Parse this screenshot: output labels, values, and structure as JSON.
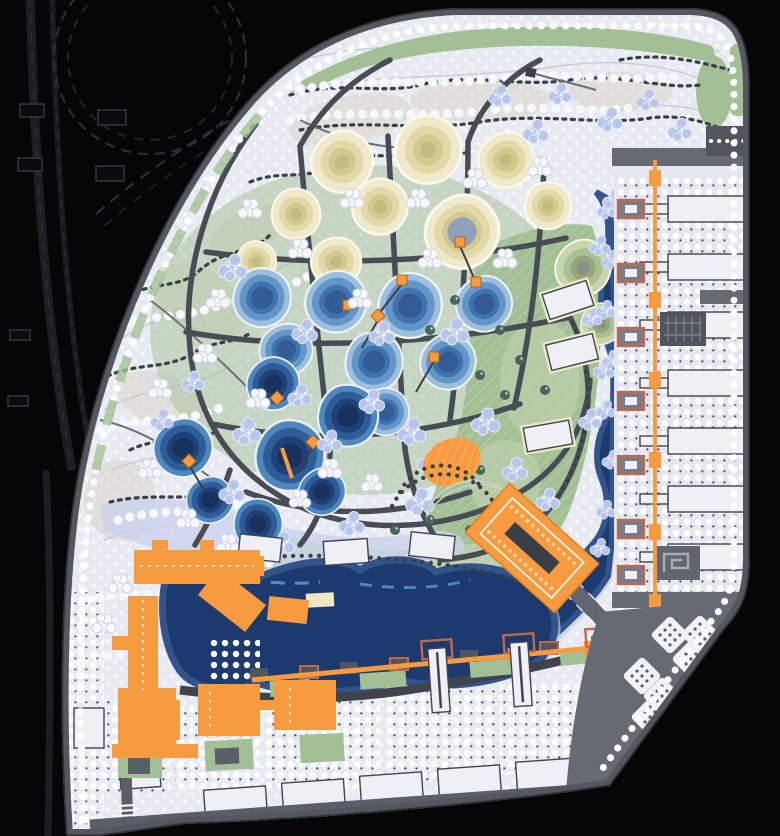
{
  "meta": {
    "type": "landscape-masterplan-site-plan",
    "canvas_px": {
      "width": 780,
      "height": 836
    },
    "visible_text": "none"
  },
  "palette": {
    "bg": "#060607",
    "highway": "#33363C",
    "highwayDim": "#1E2024",
    "ground": "#E9EBF3",
    "speckle": "#D9DCE8",
    "tan": "#D7D3C5",
    "contour": "#C7CBD8",
    "forestDot": "#3A3E46",
    "cloud": "#F7F8FC",
    "cloudEdge": "#CDD2E0",
    "green": "#A3BF95",
    "greenLight": "#BCCFAC",
    "teal": "#47645D",
    "periwinkle": "#B9C6EB",
    "periEdge": "#E9EDF8",
    "road": "#484C55",
    "roadLight": "#6A6E78",
    "perimeter": "#53575F",
    "navy": "#1C3A6E",
    "navyDeep": "#152E58",
    "shore": "#33548A",
    "shoreLight": "#8C9FC2",
    "shorePale": "#C2CBE2",
    "cyan": "#5FA8D0",
    "cream1": "#F0EACB",
    "cream2": "#E2D9A9",
    "cream3": "#D3C98F",
    "cream4": "#C2BC84",
    "creamRim": "#FBF9EE",
    "blue1": "#9DBFDE",
    "blue2": "#6295C8",
    "blue3": "#3F72AE",
    "blue4": "#2E5590",
    "dblue1": "#4E87BE",
    "dblue2": "#2F5C97",
    "dblue3": "#1F417A",
    "dblue4": "#152E58",
    "mg1": "#C9D4AE",
    "mg2": "#ACBF92",
    "mg3": "#92A87C",
    "mg4": "#8A9186",
    "orange": "#F79B40",
    "orangeDeep": "#E0821F",
    "rust": "#C0684A",
    "bldg": "#EEF0F5",
    "bldgOutline": "#40444C",
    "plaza": "#666A73",
    "plazaLight": "#9CA1AB",
    "dotShadow": "#41454D",
    "wetland": "#C9D2EC",
    "white": "#FFFFFF"
  },
  "features": [
    {
      "name": "highway-interchange",
      "color_ref": "highway",
      "location": "top-left-black-field"
    },
    {
      "name": "perimeter-road-with-tree-row",
      "color_ref": "perimeter"
    },
    {
      "name": "woodland-speckled-ground",
      "color_ref": "ground"
    },
    {
      "name": "meadow-lawns-hatched",
      "color_ref": "green"
    },
    {
      "name": "terraced-cream-mounds",
      "color_ref": "cream1",
      "count": 9
    },
    {
      "name": "green-terraced-mounds",
      "color_ref": "mg2",
      "count": 2
    },
    {
      "name": "terraced-blue-ponds",
      "color_ref": "blue3",
      "count": 8
    },
    {
      "name": "deep-navy-ponds",
      "color_ref": "dblue3",
      "count": 7
    },
    {
      "name": "orange-pond-markers",
      "color_ref": "orange",
      "count": 9
    },
    {
      "name": "river-channel-east",
      "color_ref": "navy"
    },
    {
      "name": "west-lake",
      "color_ref": "navy"
    },
    {
      "name": "orange-waterfront-buildings-southwest",
      "color_ref": "orange",
      "count": 12
    },
    {
      "name": "pier-landmark-building",
      "color_ref": "orange"
    },
    {
      "name": "amphitheater-mound",
      "color_ref": "orange"
    },
    {
      "name": "orange-promenade-axis-east",
      "color_ref": "orange"
    },
    {
      "name": "orange-promenade-axis-south",
      "color_ref": "orange"
    },
    {
      "name": "white-slab-buildings-east-strip",
      "count": 7
    },
    {
      "name": "white-row-buildings-south-strip",
      "count": 6
    },
    {
      "name": "lawn-pavilions-white",
      "count": 6
    },
    {
      "name": "waterfront-towers",
      "count": 3
    },
    {
      "name": "tree-diamond-clusters-plaza",
      "count": 8
    },
    {
      "name": "southeast-plaza",
      "color_ref": "plaza"
    },
    {
      "name": "diagonal-bridge-road",
      "color_ref": "plaza"
    },
    {
      "name": "periwinkle-tree-clumps",
      "color_ref": "periwinkle"
    },
    {
      "name": "white-dot-tree-grids",
      "color_ref": "white"
    }
  ]
}
